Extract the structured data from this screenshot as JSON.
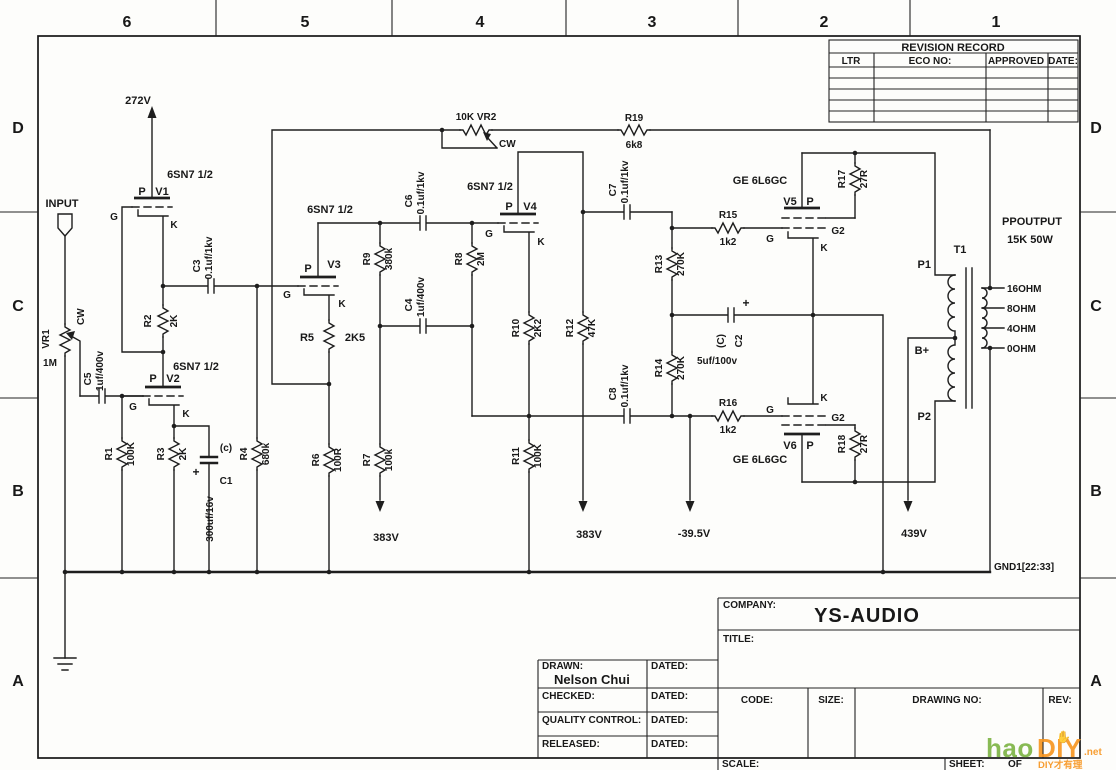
{
  "border": {
    "cols": [
      "6",
      "5",
      "4",
      "3",
      "2",
      "1"
    ],
    "rows": [
      "D",
      "C",
      "B",
      "A"
    ]
  },
  "revision": {
    "title": "REVISION RECORD",
    "col_ltr": "LTR",
    "col_eco": "ECO NO:",
    "col_approved": "APPROVED",
    "col_date": "DATE:"
  },
  "title_block": {
    "company_label": "COMPANY:",
    "company_name": "YS-AUDIO",
    "title_label": "TITLE:",
    "drawn_label": "DRAWN:",
    "drawn_name": "Nelson Chui",
    "dated_label": "DATED:",
    "checked_label": "CHECKED:",
    "qc_label": "QUALITY CONTROL:",
    "released_label": "RELEASED:",
    "code_label": "CODE:",
    "size_label": "SIZE:",
    "drawing_no_label": "DRAWING NO:",
    "rev_label": "REV:",
    "scale_label": "SCALE:",
    "sheet_label": "SHEET:",
    "of_label": "OF"
  },
  "watermark": {
    "hao": "hao",
    "diy": "DIY",
    "net": ".net",
    "tagline": "DIY才有理",
    "hand": "✋"
  },
  "sch": {
    "input": "INPUT",
    "gnd": "GND1[22:33]",
    "supply": {
      "v272": "272V",
      "v383a": "383V",
      "v383b": "383V",
      "bias": "-39.5V",
      "v439": "439V"
    },
    "tube": {
      "v1": {
        "type": "6SN7 1/2",
        "p": "P",
        "name": "V1",
        "g": "G",
        "k": "K"
      },
      "v2": {
        "type": "6SN7 1/2",
        "p": "P",
        "name": "V2",
        "g": "G",
        "k": "K"
      },
      "v3": {
        "type": "6SN7 1/2",
        "p": "P",
        "name": "V3",
        "g": "G",
        "k": "K"
      },
      "v4": {
        "type": "6SN7 1/2",
        "p": "P",
        "name": "V4",
        "g": "G",
        "k": "K"
      },
      "v5": {
        "type": "GE 6L6GC",
        "p": "P",
        "name": "V5",
        "g": "G",
        "g2": "G2",
        "k": "K"
      },
      "v6": {
        "type": "GE 6L6GC",
        "p": "P",
        "name": "V6",
        "g": "G",
        "g2": "G2",
        "k": "K"
      }
    },
    "part": {
      "vr1": {
        "ref": "VR1",
        "val": "1M",
        "cw": "CW"
      },
      "vr2": {
        "ref": "10K VR2",
        "cw": "CW"
      },
      "r1": {
        "ref": "R1",
        "val": "100K"
      },
      "r2": {
        "ref": "R2",
        "val": "2K"
      },
      "r3": {
        "ref": "R3",
        "val": "2K"
      },
      "r4": {
        "ref": "R4",
        "val": "680k"
      },
      "r5": {
        "ref": "R5",
        "val": "2K5"
      },
      "r6": {
        "ref": "R6",
        "val": "100R"
      },
      "r7": {
        "ref": "R7",
        "val": "100k"
      },
      "r8": {
        "ref": "R8",
        "val": "2M"
      },
      "r9": {
        "ref": "R9",
        "val": "380k"
      },
      "r10": {
        "ref": "R10",
        "val": "2K2"
      },
      "r11": {
        "ref": "R11",
        "val": "100K"
      },
      "r12": {
        "ref": "R12",
        "val": "47K"
      },
      "r13": {
        "ref": "R13",
        "val": "270K"
      },
      "r14": {
        "ref": "R14",
        "val": "270K"
      },
      "r15": {
        "ref": "R15",
        "val": "1k2"
      },
      "r16": {
        "ref": "R16",
        "val": "1k2"
      },
      "r17": {
        "ref": "R17",
        "val": "27R"
      },
      "r18": {
        "ref": "R18",
        "val": "27R"
      },
      "r19": {
        "ref": "R19",
        "val": "6k8"
      },
      "c1": {
        "ref": "C1",
        "val": "300uf/16v",
        "note": "(c)",
        "plus": "+"
      },
      "c2": {
        "ref": "C2",
        "val": "5uf/100v",
        "note": "(C)",
        "plus": "+"
      },
      "c3": {
        "ref": "C3",
        "val": "0.1uf/1kv"
      },
      "c4": {
        "ref": "C4",
        "val": "1uf/400v"
      },
      "c5": {
        "ref": "C5",
        "val": "1uf/400v"
      },
      "c6": {
        "ref": "C6",
        "val": "0.1uf/1kv"
      },
      "c7": {
        "ref": "C7",
        "val": "0.1uf/1kv"
      },
      "c8": {
        "ref": "C8",
        "val": "0.1uf/1kv"
      }
    },
    "xfmr": {
      "ref": "T1",
      "p1": "P1",
      "p2": "P2",
      "bplus": "B+",
      "name": "PPOUTPUT",
      "rating": "15K 50W",
      "taps": [
        "16OHM",
        "8OHM",
        "4OHM",
        "0OHM"
      ]
    }
  }
}
